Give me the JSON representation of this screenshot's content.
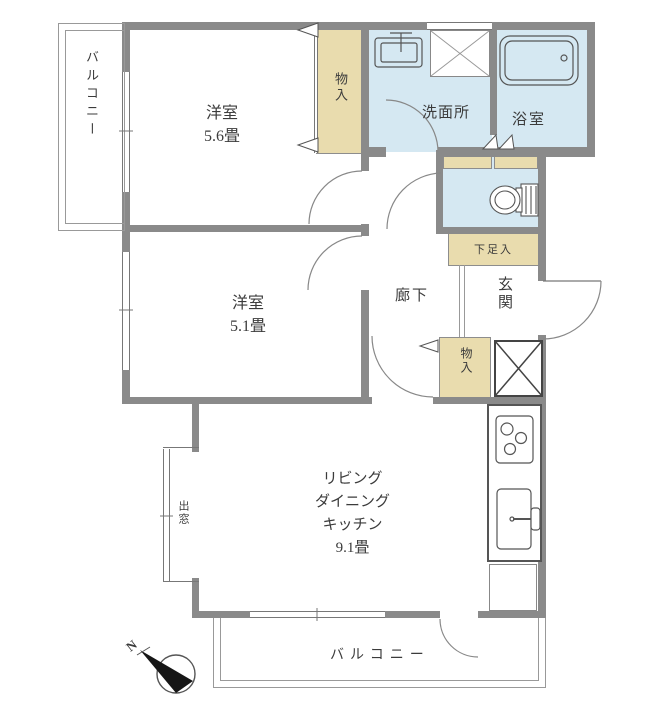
{
  "colors": {
    "wall": "#8a8a8a",
    "wet": "#d5e8f2",
    "storage": "#e9dcae",
    "line": "#8a8a8a",
    "text": "#3b3b3b"
  },
  "labels": {
    "balcony_left": "バルコニー",
    "room_5_6": {
      "name": "洋室",
      "size": "5.6畳"
    },
    "room_5_1": {
      "name": "洋室",
      "size": "5.1畳"
    },
    "storage_top": "物入",
    "washroom": "洗面所",
    "bathroom": "浴室",
    "shoe_cabinet": "下足入",
    "entrance": "玄関",
    "hallway": "廊下",
    "storage_lower": "物入",
    "ldk": {
      "line1": "リビング",
      "line2": "ダイニング",
      "line3": "キッチン",
      "size": "9.1畳"
    },
    "bay_window": "出窓",
    "balcony_bottom": "バルコニー",
    "compass_north": "N"
  }
}
